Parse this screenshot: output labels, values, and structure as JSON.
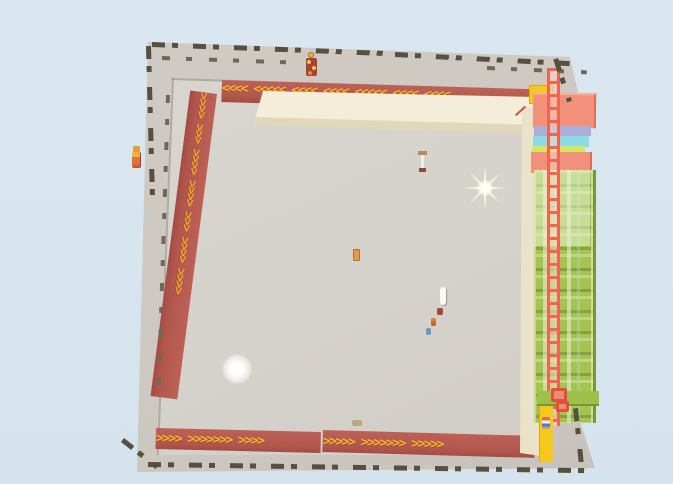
{
  "scene": {
    "title": "Top-down arena map",
    "description": "Aerial top-down view of a walled game arena with a counterclockwise perimeter boost track (red strips with yellow chevrons), a cream ledge along the top and right, lime-green grandstand structures with a red chain-ladder on the right edge, dark dashed perimeter fences, a star sparkle, a glowing orb and tiny characters on the floor"
  },
  "palette": {
    "sky": "#dae7f0",
    "sky2": "#d4e3ee",
    "ground": "#cdc8c1",
    "floor": "#d6d2cc",
    "strip": "#b2574e",
    "chevron": "#f7b52c",
    "cream": "#f5eedb",
    "creamShade": "#e1d7ba",
    "green": "#a6c351",
    "chain": "#ee6550",
    "salmon": "#f2907a",
    "periwinkle": "#a9aeda",
    "cyan": "#8cdbe7",
    "yellowgreen": "#d5e465",
    "yellow": "#f7c81b",
    "fence": "#57503f"
  },
  "arrows": {
    "top_strip": "<<<<  <<<<<  <<<<  <<<<  <<<<<  <<<<  <<<<",
    "left_strip": ">>>>  >>>  >>>>  >>>>  >>>  >>>>  >>>>",
    "bottom_strip_1": ">>>>  >>>>>>>  >>>>",
    "bottom_strip_2": ">>>>>  >>>>>>>  >>>>>"
  },
  "entities": {
    "star_sparkle": "bright star sparkle effect",
    "glow_orb": "soft white glowing orb",
    "wall_character": "small red-and-yellow character on top wall",
    "figure_outside_left": "small orange figure outside left wall",
    "mini_figure_bottom_right": "tiny multicolor figure on yellow strip",
    "floor_dots": "tiny player figures on arena floor"
  }
}
